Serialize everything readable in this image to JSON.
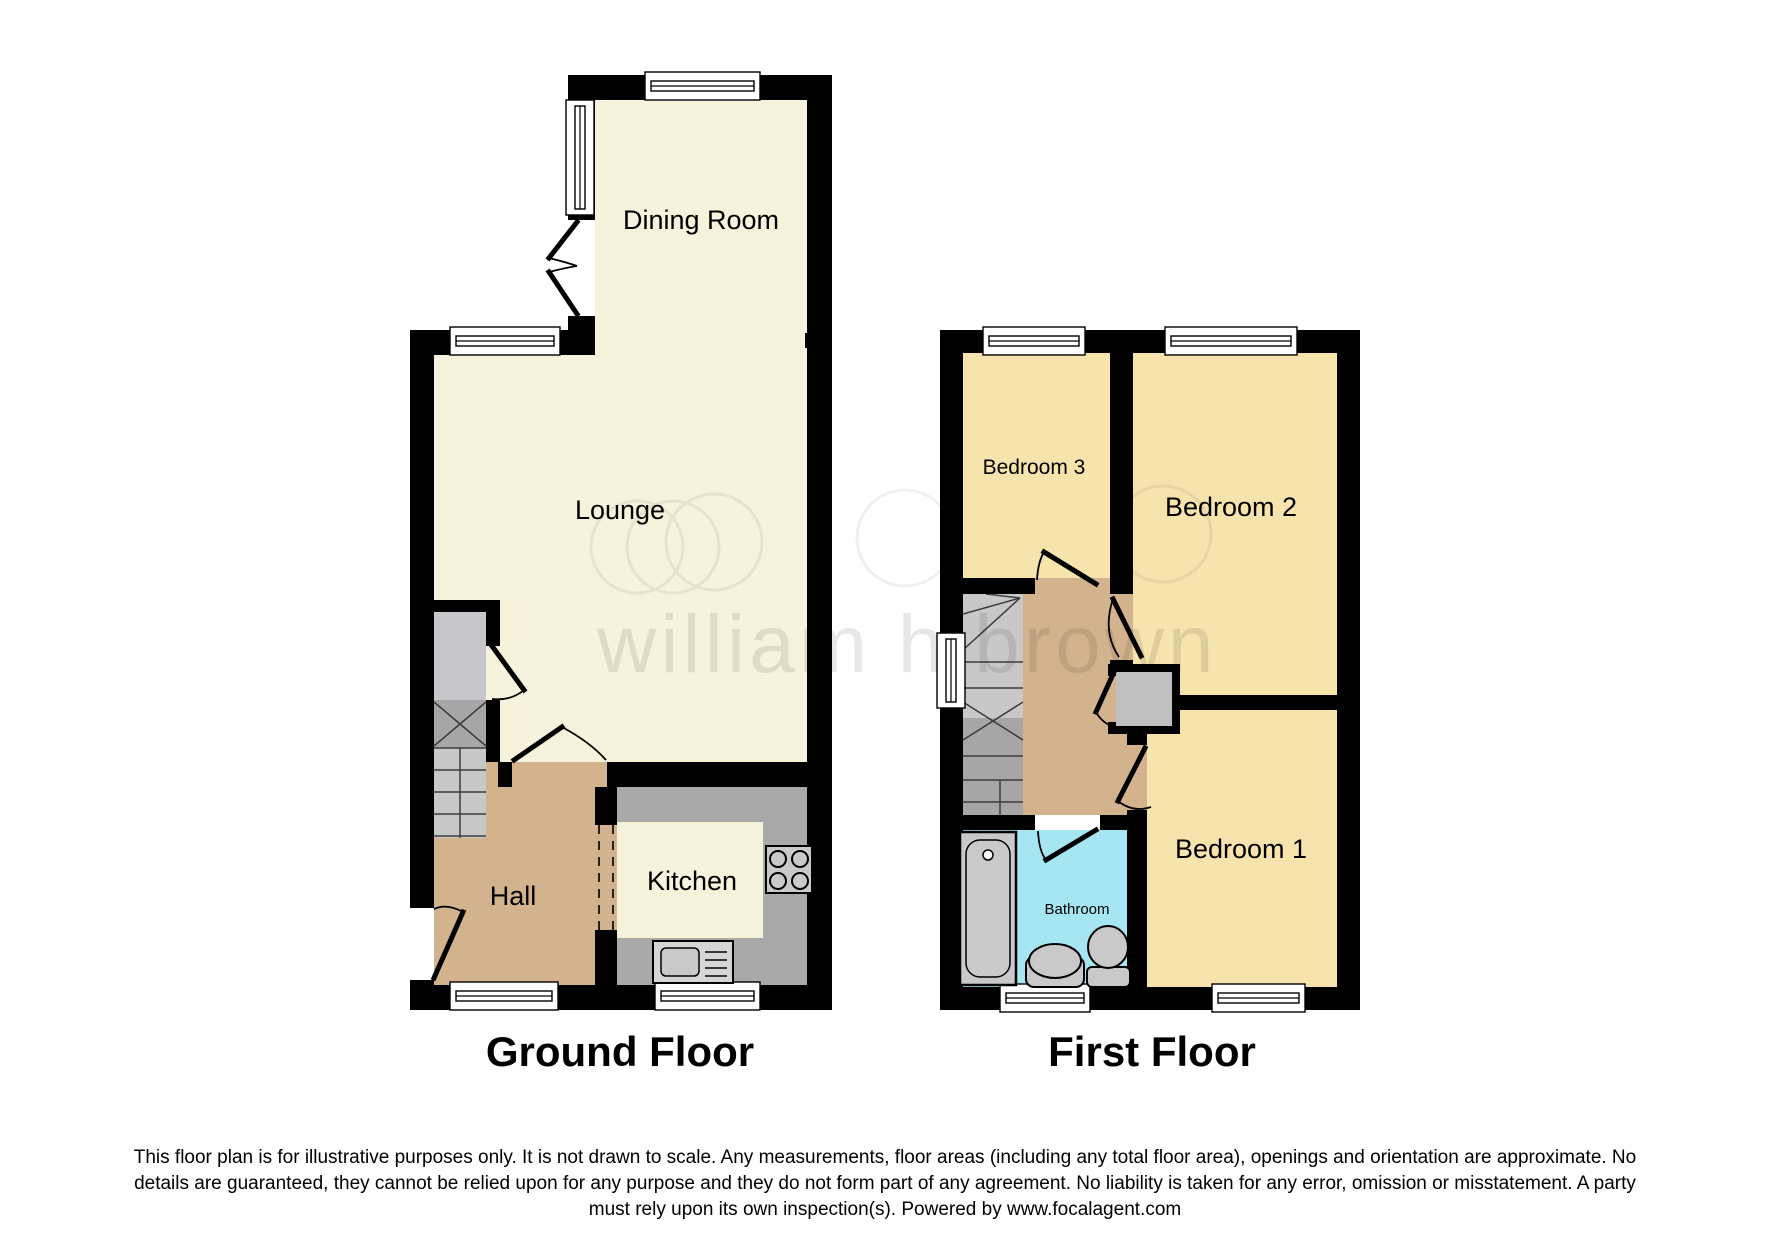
{
  "watermark": {
    "text": "william h brown"
  },
  "ground_floor": {
    "title": "Ground Floor",
    "rooms": {
      "dining": "Dining Room",
      "lounge": "Lounge",
      "hall": "Hall",
      "kitchen": "Kitchen"
    }
  },
  "first_floor": {
    "title": "First Floor",
    "rooms": {
      "bedroom3": "Bedroom 3",
      "bedroom2": "Bedroom 2",
      "bedroom1": "Bedroom 1",
      "bathroom": "Bathroom"
    }
  },
  "disclaimer": {
    "line1": "This floor plan is for illustrative purposes only. It is not drawn to scale. Any measurements, floor areas (including any total floor area), openings and orientation are approximate. No",
    "line2": "details are guaranteed, they cannot be relied upon for any purpose and they do not form part of any agreement. No liability is taken for any error, omission or misstatement. A party",
    "line3": "must rely upon its own inspection(s). Powered by www.focalagent.com"
  },
  "colors": {
    "wall": "#000000",
    "ground_room": "#F7F2DB",
    "bedroom": "#F6E4AC",
    "hall": "#D3B38E",
    "bathroom": "#A6E6F2",
    "counter": "#A9A9A9",
    "island": "#F7F2DB",
    "fixture": "#C9C9C9",
    "stair_light": "#C8C8C8",
    "stair_dark": "#A6A6A6",
    "cupboard": "#C7C7CB",
    "watermark": "#000000"
  }
}
